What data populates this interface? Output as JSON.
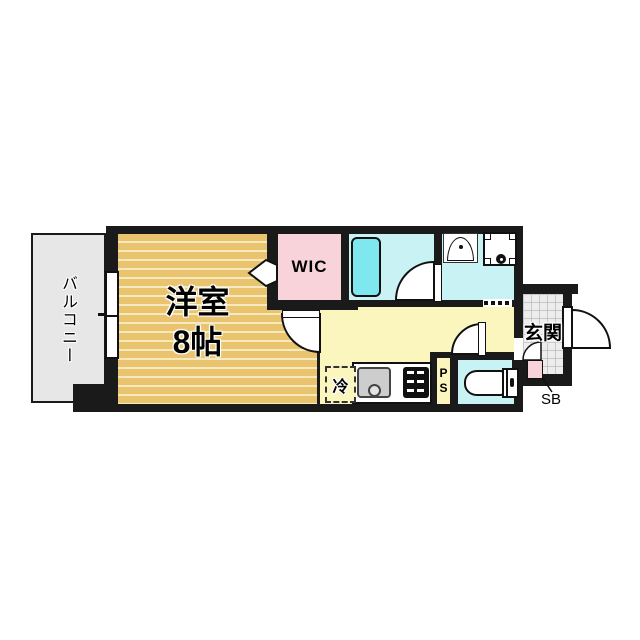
{
  "type": "floor_plan",
  "rooms": {
    "balcony": {
      "label": "バルコニー"
    },
    "western_room": {
      "label": "洋室",
      "size_label": "8帖"
    },
    "walk_in_closet": {
      "label": "WIC"
    },
    "entrance": {
      "label": "玄関"
    },
    "refrigerator_space": {
      "label": "冷"
    },
    "pipe_space": {
      "label": "PS"
    },
    "shoe_box": {
      "label": "SB"
    }
  },
  "colors": {
    "wall": "#1a1a1a",
    "wood_floor": "#e9c36d",
    "wood_stripe": "#f5e9c0",
    "balcony_floor": "#e7e7e7",
    "wic_floor": "#f8d4da",
    "bath_floor": "#c9f2f5",
    "bathtub": "#7fe8ef",
    "kitchen_floor": "#fbf6bd",
    "entrance_tile": "#ededed",
    "shoe_box_fill": "#f8d4da",
    "background": "#ffffff"
  }
}
